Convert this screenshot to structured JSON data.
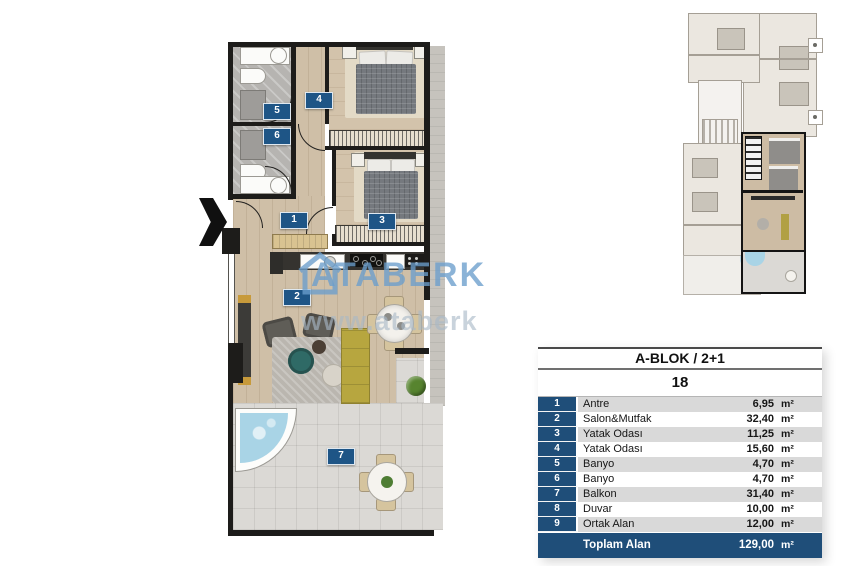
{
  "floorplan": {
    "labels": [
      {
        "num": "1",
        "room": "Antre"
      },
      {
        "num": "2",
        "room": "Salon&Mutfak"
      },
      {
        "num": "3",
        "room": "Yatak Odası"
      },
      {
        "num": "4",
        "room": "Yatak Odası"
      },
      {
        "num": "5",
        "room": "Banyo"
      },
      {
        "num": "6",
        "room": "Banyo"
      },
      {
        "num": "7",
        "room": "Balkon"
      }
    ],
    "watermark": {
      "brand": "ATABERK",
      "url_text": "www.ataberk",
      "logo": "house-outline-icon",
      "brand_color": "#6A9DCC"
    },
    "entrance_arrow": "chevron-right"
  },
  "area_table": {
    "title": "A-BLOK  /  2+1",
    "unit_number": "18",
    "rows": [
      {
        "no": "1",
        "label": "Antre",
        "value": "6,95",
        "unit": "m²"
      },
      {
        "no": "2",
        "label": "Salon&Mutfak",
        "value": "32,40",
        "unit": "m²"
      },
      {
        "no": "3",
        "label": "Yatak Odası",
        "value": "11,25",
        "unit": "m²"
      },
      {
        "no": "4",
        "label": "Yatak Odası",
        "value": "15,60",
        "unit": "m²"
      },
      {
        "no": "5",
        "label": "Banyo",
        "value": "4,70",
        "unit": "m²"
      },
      {
        "no": "6",
        "label": "Banyo",
        "value": "4,70",
        "unit": "m²"
      },
      {
        "no": "7",
        "label": "Balkon",
        "value": "31,40",
        "unit": "m²"
      },
      {
        "no": "8",
        "label": "Duvar",
        "value": "10,00",
        "unit": "m²"
      },
      {
        "no": "9",
        "label": "Ortak Alan",
        "value": "12,00",
        "unit": "m²"
      }
    ],
    "total": {
      "label": "Toplam Alan",
      "value": "129,00",
      "unit": "m²"
    },
    "colors": {
      "accent": "#1F4E79",
      "alt_row": "#D9D9D9"
    }
  }
}
